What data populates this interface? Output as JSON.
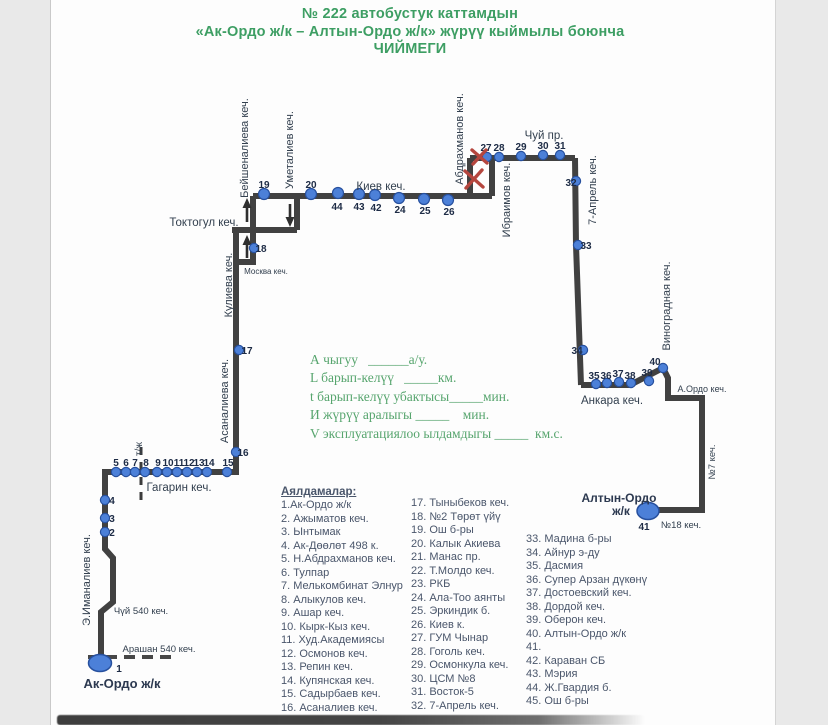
{
  "title": {
    "line1": "№ 222  автобустук каттамдын",
    "line2": "«Ак-Ордо  ж/к –  Алтын-Ордо ж/к» жүрүү кыймылы боюнча",
    "line3": "ЧИЙМЕГИ"
  },
  "form": {
    "lines": [
      "А чыгуу   ______а/у.",
      "L барып-келүү   _____км.",
      "t барып-келүү убактысы_____мин.",
      "И жүрүү аралыгы _____    мин.",
      "V эксплуатациялоо ылдамдыгы _____  км.с."
    ]
  },
  "map": {
    "terminal_start": {
      "label": "Ак-Ордо  ж/к",
      "stop_no": "1"
    },
    "terminal_end": {
      "label": "Алтын-Ордо",
      "label2": "ж/к",
      "stop_no": "41"
    },
    "street_labels": [
      {
        "text": "Бейшеналиева кеч.",
        "x": 248,
        "y": 148,
        "rot": -90,
        "size": 11
      },
      {
        "text": "Уметалиев  кеч.",
        "x": 293,
        "y": 150,
        "rot": -90,
        "size": 11
      },
      {
        "text": "Киев кеч.",
        "x": 381,
        "y": 190,
        "rot": 0,
        "size": 11.5
      },
      {
        "text": "Абдрахманов кеч.",
        "x": 463,
        "y": 139,
        "rot": -90,
        "size": 11
      },
      {
        "text": "Ибраимов кеч.",
        "x": 510,
        "y": 200,
        "rot": -90,
        "size": 11
      },
      {
        "text": "Чуй пр.",
        "x": 544,
        "y": 139,
        "rot": 0,
        "size": 11.5
      },
      {
        "text": "7-Апрель кеч.",
        "x": 596,
        "y": 190,
        "rot": -90,
        "size": 11
      },
      {
        "text": "Виноградная кеч.",
        "x": 670,
        "y": 306,
        "rot": -90,
        "size": 11
      },
      {
        "text": "Анкара кеч.",
        "x": 612,
        "y": 404,
        "rot": 0,
        "size": 11.5
      },
      {
        "text": "А.Ордо кеч.",
        "x": 702,
        "y": 392,
        "rot": 0,
        "size": 9
      },
      {
        "text": "№7 кеч.",
        "x": 715,
        "y": 462,
        "rot": -90,
        "size": 9.5
      },
      {
        "text": "№18 кеч.",
        "x": 681,
        "y": 528,
        "rot": 0,
        "size": 9.5
      },
      {
        "text": "Токтогул кеч.",
        "x": 204,
        "y": 226,
        "rot": 0,
        "size": 11.5
      },
      {
        "text": "Москва кеч.",
        "x": 266,
        "y": 274,
        "rot": 0,
        "size": 8
      },
      {
        "text": "Кулиева кеч.",
        "x": 232,
        "y": 285,
        "rot": -90,
        "size": 11
      },
      {
        "text": "Асаналиева кеч.",
        "x": 228,
        "y": 401,
        "rot": -90,
        "size": 11
      },
      {
        "text": "Гагарин кеч.",
        "x": 179,
        "y": 491,
        "rot": 0,
        "size": 11.5
      },
      {
        "text": "т/ж",
        "x": 142,
        "y": 449,
        "rot": -90,
        "size": 10
      },
      {
        "text": "Э.Иманалиев кеч.",
        "x": 90,
        "y": 580,
        "rot": -90,
        "size": 11
      },
      {
        "text": "Чүй 540 кеч.",
        "x": 141,
        "y": 614,
        "rot": 0,
        "size": 9.5
      },
      {
        "text": "Арашан 540 кеч.",
        "x": 159,
        "y": 652,
        "rot": 0,
        "size": 9.5
      }
    ],
    "stops": [
      {
        "n": "2",
        "cx": 105,
        "cy": 532,
        "lx": 112,
        "ly": 536,
        "a": "s"
      },
      {
        "n": "3",
        "cx": 105,
        "cy": 518,
        "lx": 112,
        "ly": 522,
        "a": "s"
      },
      {
        "n": "4",
        "cx": 105,
        "cy": 500,
        "lx": 112,
        "ly": 504,
        "a": "s"
      },
      {
        "n": "5",
        "cx": 116,
        "cy": 472,
        "lx": 116,
        "ly": 466,
        "fs": 9.5
      },
      {
        "n": "6",
        "cx": 126,
        "cy": 472,
        "lx": 126,
        "ly": 466,
        "fs": 9.5
      },
      {
        "n": "7",
        "cx": 135,
        "cy": 472,
        "lx": 135,
        "ly": 466,
        "fs": 9.5
      },
      {
        "n": "8",
        "cx": 145,
        "cy": 472,
        "lx": 146,
        "ly": 466,
        "fs": 9.5
      },
      {
        "n": "9",
        "cx": 157,
        "cy": 472,
        "lx": 158,
        "ly": 466,
        "fs": 9.5
      },
      {
        "n": "10",
        "cx": 167,
        "cy": 472,
        "lx": 168,
        "ly": 466,
        "fs": 9.5
      },
      {
        "n": "11",
        "cx": 177,
        "cy": 472,
        "lx": 179,
        "ly": 466,
        "fs": 9.5
      },
      {
        "n": "12",
        "cx": 187,
        "cy": 472,
        "lx": 189,
        "ly": 466,
        "fs": 9.5
      },
      {
        "n": "13",
        "cx": 197,
        "cy": 472,
        "lx": 199,
        "ly": 466,
        "fs": 9.5
      },
      {
        "n": "14",
        "cx": 207,
        "cy": 472,
        "lx": 209,
        "ly": 466,
        "fs": 9.5
      },
      {
        "n": "15",
        "cx": 227,
        "cy": 472,
        "lx": 228,
        "ly": 466,
        "fs": 9.5
      },
      {
        "n": "16",
        "cx": 236,
        "cy": 452,
        "lx": 243,
        "ly": 456,
        "a": "s"
      },
      {
        "n": "17",
        "cx": 239,
        "cy": 350,
        "lx": 247,
        "ly": 354,
        "a": "s"
      },
      {
        "n": "18",
        "cx": 254,
        "cy": 248,
        "lx": 261,
        "ly": 252,
        "a": "s"
      },
      {
        "n": "19",
        "cx": 264,
        "cy": 194,
        "lx": 264,
        "ly": 188,
        "r": 5.5
      },
      {
        "n": "20",
        "cx": 311,
        "cy": 194,
        "lx": 311,
        "ly": 188,
        "r": 5.5
      },
      {
        "n": "44",
        "cx": 338,
        "cy": 193,
        "lx": 337,
        "ly": 210,
        "r": 5.5
      },
      {
        "n": "43",
        "cx": 359,
        "cy": 194,
        "lx": 359,
        "ly": 210,
        "r": 5.5
      },
      {
        "n": "42",
        "cx": 375,
        "cy": 195,
        "lx": 376,
        "ly": 211,
        "r": 5.5
      },
      {
        "n": "24",
        "cx": 399,
        "cy": 198,
        "lx": 400,
        "ly": 213,
        "r": 5.5
      },
      {
        "n": "25",
        "cx": 424,
        "cy": 199,
        "lx": 425,
        "ly": 214,
        "r": 5.5
      },
      {
        "n": "26",
        "cx": 448,
        "cy": 200,
        "lx": 449,
        "ly": 215,
        "r": 5.5
      },
      {
        "n": "27",
        "cx": 487,
        "cy": 157,
        "lx": 486,
        "ly": 151
      },
      {
        "n": "28",
        "cx": 499,
        "cy": 157,
        "lx": 499,
        "ly": 151
      },
      {
        "n": "29",
        "cx": 521,
        "cy": 156,
        "lx": 521,
        "ly": 150
      },
      {
        "n": "30",
        "cx": 543,
        "cy": 155,
        "lx": 543,
        "ly": 149
      },
      {
        "n": "31",
        "cx": 560,
        "cy": 155,
        "lx": 560,
        "ly": 149
      },
      {
        "n": "32",
        "cx": 576,
        "cy": 181,
        "lx": 571,
        "ly": 186,
        "a": "e"
      },
      {
        "n": "33",
        "cx": 578,
        "cy": 245,
        "lx": 586,
        "ly": 249,
        "a": "s"
      },
      {
        "n": "34",
        "cx": 583,
        "cy": 350,
        "lx": 577,
        "ly": 354,
        "a": "e"
      },
      {
        "n": "35",
        "cx": 596,
        "cy": 384,
        "lx": 594,
        "ly": 379,
        "fs": 9
      },
      {
        "n": "36",
        "cx": 607,
        "cy": 383,
        "lx": 606,
        "ly": 379,
        "fs": 9
      },
      {
        "n": "37",
        "cx": 619,
        "cy": 382,
        "lx": 618,
        "ly": 377,
        "fs": 9
      },
      {
        "n": "38",
        "cx": 631,
        "cy": 383,
        "lx": 630,
        "ly": 379,
        "fs": 9
      },
      {
        "n": "39",
        "cx": 649,
        "cy": 381,
        "lx": 647,
        "ly": 376,
        "fs": 9
      },
      {
        "n": "40",
        "cx": 663,
        "cy": 368,
        "lx": 655,
        "ly": 365,
        "a": "e"
      }
    ]
  },
  "stop_list": {
    "header": "Аялдамалар:",
    "col1": [
      "1.Ак-Ордо ж/к",
      "2. Ажыматов кеч.",
      "3. Ынтымак",
      "4. Ак-Дөөлөт 498 к.",
      "5. Н.Абдрахманов кеч.",
      "6. Тулпар",
      "7. Мелькомбинат Элнур",
      "8. Алыкулов кеч.",
      "9. Ашар кеч.",
      "10. Кырк-Кыз кеч.",
      "11. Худ.Академиясы",
      "12. Осмонов кеч.",
      "13. Репин кеч.",
      "14. Купянская кеч.",
      "15. Садырбаев кеч.",
      "16. Асаналиев кеч."
    ],
    "col2": [
      "17. Тыныбеков кеч.",
      "18. №2 Төрөт үйү",
      "19. Ош б-ры",
      "20. Калык Акиева",
      "21. Манас пр.",
      "22. Т.Молдо кеч.",
      "23. РКБ",
      "24. Ала-Тоо аянты",
      "25. Эркиндик б.",
      "26. Киев к.",
      "27. ГУМ Чынар",
      "28. Гоголь кеч.",
      "29. Осмонкула кеч.",
      "30. ЦСМ №8",
      "31. Восток-5",
      "32. 7-Апрель кеч."
    ],
    "col3": [
      "33. Мадина б-ры",
      "34. Айнур э-ду",
      "35. Дасмия",
      "36. Супер Арзан дүкөнү",
      "37. Достоевский кеч.",
      "38. Дордой кеч.",
      "39. Оберон кеч.",
      "40. Алтын-Ордо ж/к",
      "41.",
      "42. Караван СБ",
      "43. Мэрия",
      "44. Ж.Гвардия б.",
      "45. Ош б-ры"
    ]
  },
  "colors": {
    "background_gray": "#e9e9e9",
    "paper_white": "#fdfdfd",
    "title_green": "#3d9e63",
    "form_green": "#57a56e",
    "route_line_gray": "#414141",
    "stop_dot_blue": "#4c80d8",
    "stop_dot_border_blue": "#27509e",
    "text_navy": "#1d2b45",
    "list_text_gray": "#4a566b",
    "closed_x_red": "#b5463e"
  }
}
